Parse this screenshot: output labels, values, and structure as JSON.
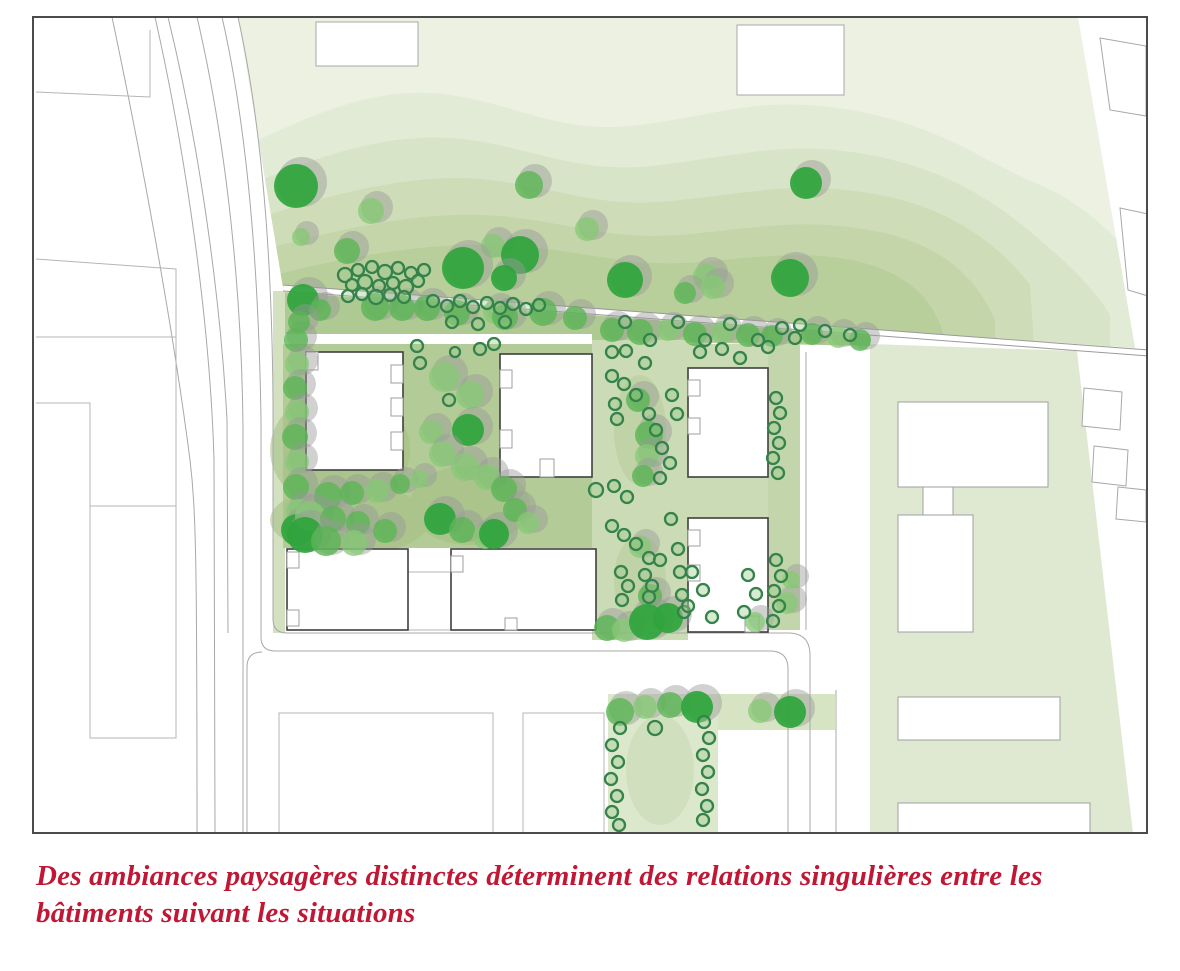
{
  "caption": {
    "line1": "Des ambiances paysagères distinctes déterminent des relations singulières entre les",
    "line2": "bâtiments suivant les situations",
    "color": "#c11735"
  },
  "palette": {
    "page_background": "#ffffff",
    "map_border": "#4b4b4b",
    "band1": "#ecf1e2",
    "band2": "#e2ebd5",
    "band3": "#d8e4c7",
    "band4": "#cedcb8",
    "band5": "#c3d5a9",
    "band6": "#b8ce9b",
    "strip_band": "#afc992",
    "courtyard": "#b3cb97",
    "courtyard_blob": "#a3c083",
    "central_path": "#cadbb5",
    "right_strip": "#c3d6ab",
    "trapezoid": "#dfe9d2",
    "bottom_path": "#dce8cc",
    "l_strip": "#d7e4c3",
    "left_sliver": "#d3e1c0",
    "tree_dark": "#2fa53c",
    "tree_medium": "#5ab554",
    "tree_light": "#86ca74",
    "tree_shadow": "#9a9a9a",
    "shrub_stroke": "#35824b",
    "shrub_fill": "#9ccb8e",
    "building_stroke": "#3f3f3f",
    "building_fill": "#ffffff",
    "neighbor_stroke": "#a8a8a8",
    "road_stroke": "#a8a8a8",
    "boundary_line": "#9a9a9a"
  },
  "trees": [
    [
      296,
      186,
      22,
      "d"
    ],
    [
      371,
      211,
      13,
      "l"
    ],
    [
      301,
      237,
      9,
      "l"
    ],
    [
      347,
      251,
      13,
      "m"
    ],
    [
      529,
      185,
      14,
      "m"
    ],
    [
      587,
      229,
      12,
      "l"
    ],
    [
      493,
      246,
      12,
      "l"
    ],
    [
      463,
      268,
      21,
      "d"
    ],
    [
      520,
      255,
      19,
      "d"
    ],
    [
      504,
      278,
      13,
      "d"
    ],
    [
      625,
      280,
      18,
      "d"
    ],
    [
      706,
      277,
      13,
      "l"
    ],
    [
      685,
      293,
      11,
      "m"
    ],
    [
      713,
      287,
      12,
      "l"
    ],
    [
      790,
      278,
      19,
      "d"
    ],
    [
      806,
      183,
      16,
      "d"
    ],
    [
      303,
      300,
      16,
      "d"
    ],
    [
      320,
      310,
      11,
      "m"
    ],
    [
      375,
      307,
      14,
      "m"
    ],
    [
      402,
      308,
      13,
      "m"
    ],
    [
      427,
      308,
      13,
      "m"
    ],
    [
      457,
      313,
      13,
      "m"
    ],
    [
      495,
      312,
      12,
      "l"
    ],
    [
      505,
      317,
      13,
      "m"
    ],
    [
      543,
      312,
      14,
      "m"
    ],
    [
      575,
      318,
      12,
      "m"
    ],
    [
      612,
      330,
      12,
      "m"
    ],
    [
      640,
      332,
      13,
      "m"
    ],
    [
      668,
      330,
      11,
      "l"
    ],
    [
      695,
      334,
      12,
      "m"
    ],
    [
      722,
      332,
      11,
      "l"
    ],
    [
      748,
      335,
      12,
      "m"
    ],
    [
      772,
      336,
      11,
      "m"
    ],
    [
      812,
      334,
      11,
      "m"
    ],
    [
      838,
      337,
      11,
      "l"
    ],
    [
      860,
      340,
      11,
      "m"
    ],
    [
      296,
      340,
      12,
      "m"
    ],
    [
      297,
      364,
      12,
      "l"
    ],
    [
      295,
      388,
      12,
      "m"
    ],
    [
      297,
      412,
      12,
      "l"
    ],
    [
      295,
      437,
      13,
      "m"
    ],
    [
      297,
      462,
      12,
      "l"
    ],
    [
      296,
      487,
      13,
      "m"
    ],
    [
      298,
      511,
      12,
      "l"
    ],
    [
      297,
      530,
      16,
      "d"
    ],
    [
      299,
      322,
      11,
      "m"
    ],
    [
      444,
      377,
      15,
      "l"
    ],
    [
      470,
      395,
      14,
      "l"
    ],
    [
      431,
      432,
      12,
      "l"
    ],
    [
      468,
      430,
      16,
      "d"
    ],
    [
      442,
      454,
      13,
      "l"
    ],
    [
      465,
      467,
      14,
      "l"
    ],
    [
      487,
      477,
      13,
      "l"
    ],
    [
      504,
      489,
      13,
      "m"
    ],
    [
      328,
      496,
      14,
      "m"
    ],
    [
      352,
      493,
      12,
      "m"
    ],
    [
      377,
      491,
      12,
      "l"
    ],
    [
      400,
      484,
      10,
      "m"
    ],
    [
      419,
      479,
      9,
      "l"
    ],
    [
      310,
      516,
      15,
      "l"
    ],
    [
      333,
      519,
      13,
      "m"
    ],
    [
      358,
      523,
      12,
      "m"
    ],
    [
      305,
      535,
      18,
      "d"
    ],
    [
      326,
      541,
      15,
      "m"
    ],
    [
      354,
      543,
      13,
      "l"
    ],
    [
      385,
      531,
      12,
      "m"
    ],
    [
      440,
      519,
      16,
      "d"
    ],
    [
      462,
      530,
      13,
      "m"
    ],
    [
      485,
      537,
      12,
      "l"
    ],
    [
      494,
      534,
      15,
      "d"
    ],
    [
      515,
      510,
      12,
      "m"
    ],
    [
      528,
      523,
      11,
      "l"
    ],
    [
      638,
      400,
      12,
      "m"
    ],
    [
      649,
      435,
      14,
      "m"
    ],
    [
      647,
      456,
      12,
      "l"
    ],
    [
      643,
      476,
      11,
      "m"
    ],
    [
      640,
      547,
      11,
      "l"
    ],
    [
      650,
      596,
      12,
      "m"
    ],
    [
      607,
      628,
      13,
      "m"
    ],
    [
      624,
      630,
      12,
      "l"
    ],
    [
      647,
      622,
      18,
      "d"
    ],
    [
      668,
      618,
      15,
      "d"
    ],
    [
      787,
      603,
      11,
      "l"
    ],
    [
      791,
      580,
      9,
      "l"
    ],
    [
      755,
      622,
      10,
      "l"
    ],
    [
      620,
      712,
      14,
      "m"
    ],
    [
      645,
      707,
      12,
      "l"
    ],
    [
      670,
      705,
      13,
      "m"
    ],
    [
      697,
      707,
      16,
      "d"
    ],
    [
      760,
      711,
      12,
      "l"
    ],
    [
      790,
      712,
      16,
      "d"
    ]
  ],
  "shrubs": [
    [
      417,
      346,
      6
    ],
    [
      420,
      363,
      6
    ],
    [
      455,
      352,
      5
    ],
    [
      480,
      349,
      6
    ],
    [
      494,
      344,
      6
    ],
    [
      449,
      400,
      6
    ],
    [
      345,
      275,
      7
    ],
    [
      358,
      270,
      6
    ],
    [
      372,
      267,
      6
    ],
    [
      385,
      272,
      7
    ],
    [
      398,
      268,
      6
    ],
    [
      411,
      273,
      6
    ],
    [
      424,
      270,
      6
    ],
    [
      352,
      285,
      6
    ],
    [
      365,
      282,
      7
    ],
    [
      379,
      286,
      6
    ],
    [
      393,
      283,
      6
    ],
    [
      406,
      287,
      7
    ],
    [
      418,
      281,
      6
    ],
    [
      348,
      296,
      6
    ],
    [
      362,
      294,
      6
    ],
    [
      376,
      297,
      7
    ],
    [
      390,
      295,
      6
    ],
    [
      404,
      297,
      6
    ],
    [
      433,
      301,
      6
    ],
    [
      447,
      306,
      6
    ],
    [
      460,
      301,
      6
    ],
    [
      473,
      307,
      6
    ],
    [
      487,
      303,
      6
    ],
    [
      500,
      308,
      6
    ],
    [
      513,
      304,
      6
    ],
    [
      526,
      309,
      6
    ],
    [
      539,
      305,
      6
    ],
    [
      452,
      322,
      6
    ],
    [
      478,
      324,
      6
    ],
    [
      505,
      322,
      6
    ],
    [
      625,
      322,
      6
    ],
    [
      650,
      340,
      6
    ],
    [
      678,
      322,
      6
    ],
    [
      705,
      340,
      6
    ],
    [
      730,
      324,
      6
    ],
    [
      758,
      340,
      6
    ],
    [
      782,
      328,
      6
    ],
    [
      795,
      338,
      6
    ],
    [
      800,
      325,
      6
    ],
    [
      825,
      331,
      6
    ],
    [
      850,
      335,
      6
    ],
    [
      612,
      352,
      6
    ],
    [
      626,
      351,
      6
    ],
    [
      645,
      363,
      6
    ],
    [
      612,
      376,
      6
    ],
    [
      624,
      384,
      6
    ],
    [
      615,
      404,
      6
    ],
    [
      636,
      395,
      6
    ],
    [
      649,
      414,
      6
    ],
    [
      617,
      419,
      6
    ],
    [
      656,
      430,
      6
    ],
    [
      662,
      448,
      6
    ],
    [
      660,
      478,
      6
    ],
    [
      672,
      395,
      6
    ],
    [
      677,
      414,
      6
    ],
    [
      670,
      463,
      6
    ],
    [
      596,
      490,
      7
    ],
    [
      614,
      486,
      6
    ],
    [
      627,
      497,
      6
    ],
    [
      612,
      526,
      6
    ],
    [
      624,
      535,
      6
    ],
    [
      636,
      544,
      6
    ],
    [
      649,
      558,
      6
    ],
    [
      621,
      572,
      6
    ],
    [
      645,
      575,
      6
    ],
    [
      652,
      586,
      6
    ],
    [
      628,
      586,
      6
    ],
    [
      649,
      597,
      6
    ],
    [
      622,
      600,
      6
    ],
    [
      671,
      519,
      6
    ],
    [
      678,
      549,
      6
    ],
    [
      680,
      572,
      6
    ],
    [
      682,
      595,
      6
    ],
    [
      684,
      612,
      6
    ],
    [
      660,
      560,
      6
    ],
    [
      692,
      572,
      6
    ],
    [
      703,
      590,
      6
    ],
    [
      688,
      606,
      6
    ],
    [
      712,
      617,
      6
    ],
    [
      748,
      575,
      6
    ],
    [
      756,
      594,
      6
    ],
    [
      744,
      612,
      6
    ],
    [
      776,
      398,
      6
    ],
    [
      780,
      413,
      6
    ],
    [
      774,
      428,
      6
    ],
    [
      779,
      443,
      6
    ],
    [
      773,
      458,
      6
    ],
    [
      778,
      473,
      6
    ],
    [
      776,
      560,
      6
    ],
    [
      781,
      576,
      6
    ],
    [
      774,
      591,
      6
    ],
    [
      779,
      606,
      6
    ],
    [
      773,
      621,
      6
    ],
    [
      620,
      728,
      6
    ],
    [
      612,
      745,
      6
    ],
    [
      618,
      762,
      6
    ],
    [
      611,
      779,
      6
    ],
    [
      617,
      796,
      6
    ],
    [
      612,
      812,
      6
    ],
    [
      619,
      825,
      6
    ],
    [
      704,
      722,
      6
    ],
    [
      709,
      738,
      6
    ],
    [
      703,
      755,
      6
    ],
    [
      708,
      772,
      6
    ],
    [
      702,
      789,
      6
    ],
    [
      707,
      806,
      6
    ],
    [
      703,
      820,
      6
    ],
    [
      655,
      728,
      7
    ],
    [
      700,
      352,
      6
    ],
    [
      722,
      349,
      6
    ],
    [
      740,
      358,
      6
    ],
    [
      768,
      347,
      6
    ]
  ]
}
